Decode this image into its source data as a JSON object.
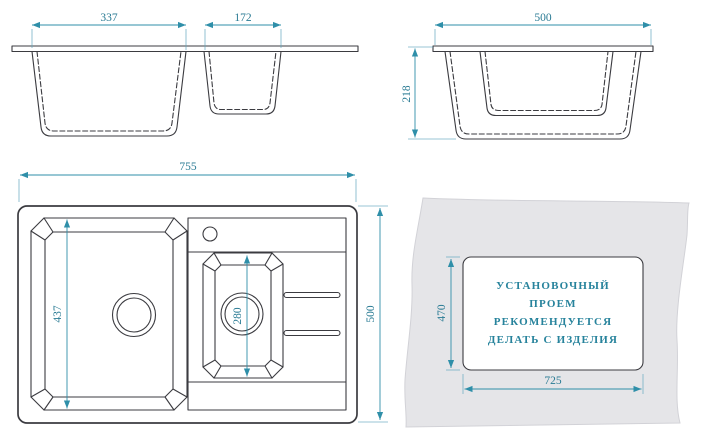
{
  "meta": {
    "description": "Technical installation drawing of a kitchen sink with one large bowl, one small bowl and a drainboard; all dimensions in mm"
  },
  "colors": {
    "outline": "#3b3b40",
    "dim_line": "#5fa5bd",
    "dim_accent": "#2f8fa9",
    "dim_text": "#2a7b94",
    "note_text": "#27839c",
    "slab_fill": "#e5e5e8",
    "slab_edge": "#d2d2d7",
    "background": "#ffffff"
  },
  "front_view": {
    "bowl1_width_mm": "337",
    "bowl2_width_mm": "172"
  },
  "side_view": {
    "width_mm": "500",
    "depth_mm": "218"
  },
  "top_view": {
    "length_mm": "755",
    "width_mm": "500",
    "bowl1_length_mm": "437",
    "bowl2_length_mm": "280"
  },
  "cutout_view": {
    "opening_height_mm": "470",
    "opening_width_mm": "725",
    "note_lines": [
      "УСТАНОВОЧНЫЙ",
      "ПРОЕМ",
      "РЕКОМЕНДУЕТСЯ",
      "ДЕЛАТЬ С ИЗДЕЛИЯ"
    ]
  }
}
